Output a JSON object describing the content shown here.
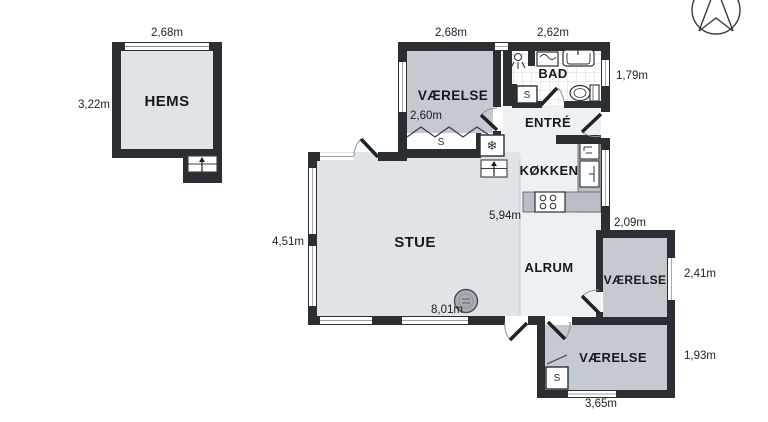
{
  "colors": {
    "wall": "#2b2e33",
    "room_blue": "#dfe4e9",
    "room_gray": "#c5cad1",
    "room_light": "#eef1f3",
    "counter": "#b9bfc5",
    "tile_line": "#d6dbe0",
    "wood_stove": "#a7adb4"
  },
  "icons": {
    "snowflake": "❄"
  },
  "closet_label": "S",
  "rooms": {
    "hems": {
      "label": "HEMS",
      "dim_width": "2,68m",
      "dim_height": "3,22m"
    },
    "vaerelse_nw": {
      "label": "VÆRELSE",
      "dim_width": "2,68m",
      "dim_inner": "2,60m"
    },
    "bad": {
      "label": "BAD",
      "dim_width": "2,62m",
      "dim_height": "1,79m"
    },
    "entre": {
      "label": "ENTRÉ"
    },
    "kokken": {
      "label": "KØKKEN"
    },
    "stue": {
      "label": "STUE",
      "dim_height": "4,51m",
      "dim_width": "8,01m",
      "dim_depth": "5,94m"
    },
    "alrum": {
      "label": "ALRUM"
    },
    "vaerelse_e": {
      "label": "VÆRELSE",
      "dim_width": "2,09m",
      "dim_height": "2,41m"
    },
    "vaerelse_se": {
      "label": "VÆRELSE",
      "dim_width": "3,65m",
      "dim_height": "1,93m"
    }
  }
}
